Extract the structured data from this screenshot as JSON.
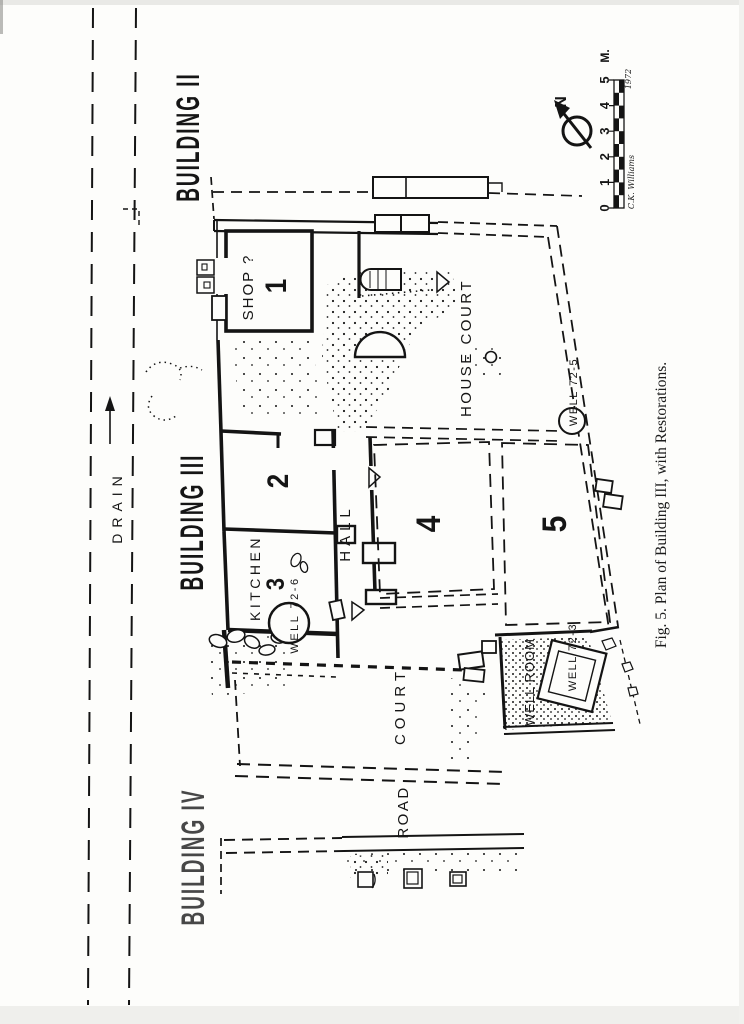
{
  "figure": {
    "caption": "Fig. 5.  Plan of Building III, with Restorations.",
    "compass_north": "N",
    "scale": {
      "ticks": [
        "0",
        "1",
        "2",
        "3",
        "4",
        "5"
      ],
      "unit": "M.",
      "signature": "C.K. Williams",
      "year": "1972"
    },
    "areas": {
      "building_ii": "BUILDING II",
      "building_iii": "BUILDING III",
      "building_iv": "BUILDING IV",
      "drain": "DRAIN",
      "road": "ROAD",
      "court": "COURT",
      "house_court": "HOUSE COURT",
      "hall": "HALL",
      "kitchen": "KITCHEN",
      "shop": "SHOP ?",
      "well_room": "WELL ROOM"
    },
    "room_numbers": {
      "r1": "1",
      "r2": "2",
      "r3": "3",
      "r4": "4",
      "r5": "5"
    },
    "wells": {
      "well_72_3": "WELL 72-3",
      "well_72_5": "WELL 72-5",
      "well_72_6": "WELL 72-6"
    }
  }
}
